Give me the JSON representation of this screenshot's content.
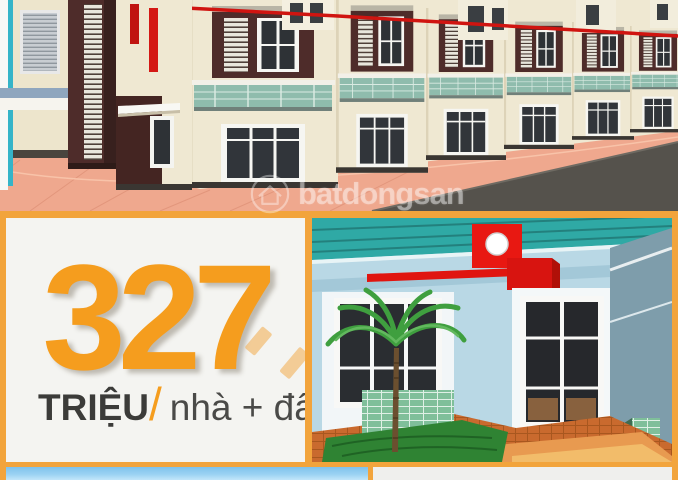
{
  "accent_frame_color": "#F2A43C",
  "price_panel": {
    "amount": "327",
    "unit": "TRIỆU",
    "slash": "/",
    "descriptor": "nhà + đất",
    "amount_color": "#F59D1E",
    "unit_color": "#3B3B39",
    "descriptor_color": "#4A4A48",
    "background": "#F4F4F1"
  },
  "watermark": {
    "text": "batdongsan",
    "icon": "house-in-circle-icon",
    "color": "#FFFFFF"
  },
  "scenes": {
    "townhouse_render": {
      "name": "row-of-townhouses-3d-render",
      "wall_color": "#EFE8D2",
      "accent_color": "#4E2C2A",
      "red_trim_color": "#D01410",
      "balcony_tile_color": "#8FBCAD",
      "pavement_color": "#EFA88E",
      "road_color": "#55524C"
    },
    "house_render": {
      "name": "single-storey-house-3d-render",
      "wall_color": "#B9D8E5",
      "roof_color": "#2FA9A5",
      "red_accent_color": "#E51510",
      "tile_base_color": "#7FBF9A",
      "paving_color": "#C96A2E",
      "grass_color": "#2F8333"
    },
    "sky_strip": {
      "name": "sky-photo-strip",
      "sky_color": "#8FD0F2"
    },
    "grey_strip": {
      "name": "blank-strip",
      "fill_color": "#EFEFED"
    }
  }
}
